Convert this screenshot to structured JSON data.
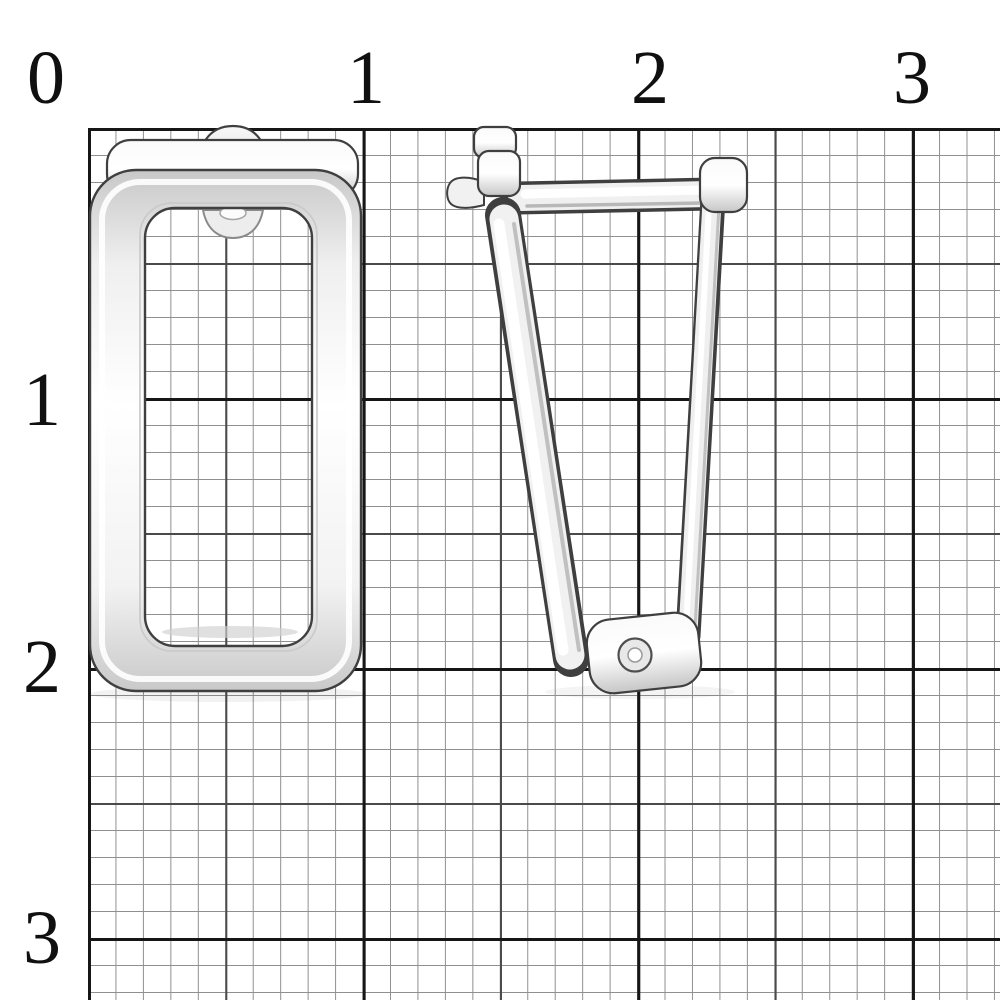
{
  "photo": {
    "subject": "Silver rectangular earring with English lock clasp, shown in front view and in side (clasp) view, photographed on millimeter graph paper",
    "views": [
      "front view",
      "side view"
    ]
  },
  "ruler": {
    "unit": "cm",
    "top_labels": [
      "0",
      "1",
      "2",
      "3"
    ],
    "left_labels": [
      "1",
      "2",
      "3"
    ]
  },
  "scale": {
    "cm_in_px_horizontal": 274.7,
    "cm_in_px_vertical": 270,
    "grid_origin_px": {
      "x": 88,
      "y": 128
    }
  },
  "colors": {
    "paper": "#ffffff",
    "grid_minor": "#909090",
    "grid_medium": "#4a4a4a",
    "grid_major": "#161616",
    "label_ink": "#101010",
    "metal_outline": "#3f3f3f",
    "metal_light": "#ffffff",
    "metal_mid": "#efefef",
    "metal_shade": "#c7c7c7"
  }
}
